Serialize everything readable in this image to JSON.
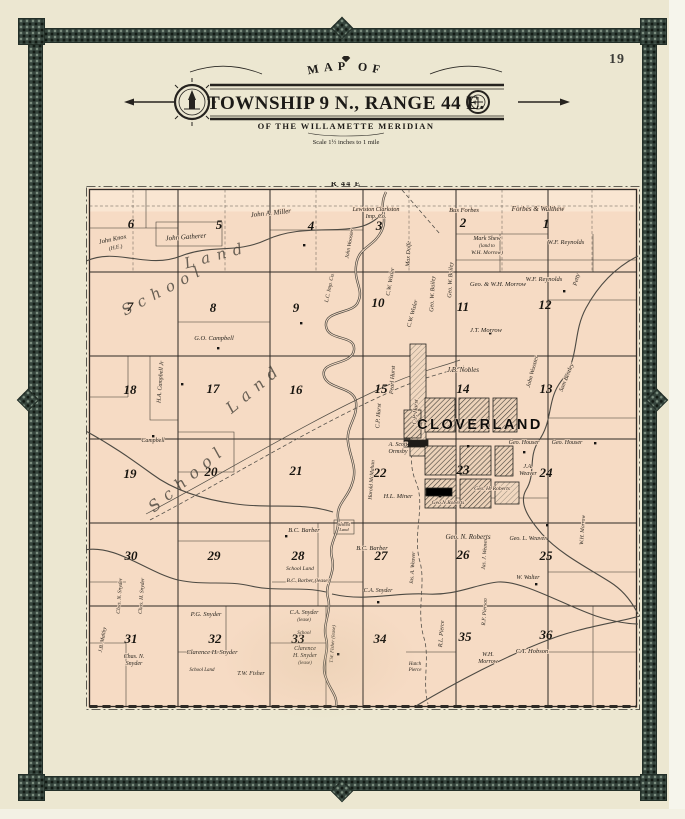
{
  "page": {
    "number": "19"
  },
  "colors": {
    "paper": "#ece7d1",
    "land": "#f6dbc4",
    "border_band": "#35443c",
    "ink": "#2e2a25"
  },
  "header": {
    "arc_title": "MAP OF",
    "main_title": "TOWNSHIP 9 N., RANGE 44 E.",
    "subtitle": "OF THE WILLAMETTE MERIDIAN",
    "scale_note": "Scale 1½ inches to 1 mile"
  },
  "map": {
    "range_label": "R 44 E",
    "town_label": "CLOVERLAND",
    "sections": [
      {
        "n": "6",
        "x": 45,
        "y": 46
      },
      {
        "n": "5",
        "x": 133,
        "y": 47
      },
      {
        "n": "4",
        "x": 225,
        "y": 48
      },
      {
        "n": "3",
        "x": 293,
        "y": 48
      },
      {
        "n": "2",
        "x": 377,
        "y": 45
      },
      {
        "n": "1",
        "x": 460,
        "y": 46
      },
      {
        "n": "7",
        "x": 44,
        "y": 129
      },
      {
        "n": "8",
        "x": 127,
        "y": 130
      },
      {
        "n": "9",
        "x": 210,
        "y": 130
      },
      {
        "n": "10",
        "x": 292,
        "y": 125
      },
      {
        "n": "11",
        "x": 377,
        "y": 129
      },
      {
        "n": "12",
        "x": 459,
        "y": 127
      },
      {
        "n": "18",
        "x": 44,
        "y": 212
      },
      {
        "n": "17",
        "x": 127,
        "y": 211
      },
      {
        "n": "16",
        "x": 210,
        "y": 212
      },
      {
        "n": "15",
        "x": 295,
        "y": 211
      },
      {
        "n": "14",
        "x": 377,
        "y": 211
      },
      {
        "n": "13",
        "x": 460,
        "y": 211
      },
      {
        "n": "19",
        "x": 44,
        "y": 296
      },
      {
        "n": "20",
        "x": 125,
        "y": 294
      },
      {
        "n": "21",
        "x": 210,
        "y": 293
      },
      {
        "n": "22",
        "x": 294,
        "y": 295
      },
      {
        "n": "23",
        "x": 377,
        "y": 292
      },
      {
        "n": "24",
        "x": 460,
        "y": 295
      },
      {
        "n": "30",
        "x": 45,
        "y": 378
      },
      {
        "n": "29",
        "x": 128,
        "y": 378
      },
      {
        "n": "28",
        "x": 212,
        "y": 378
      },
      {
        "n": "27",
        "x": 295,
        "y": 378
      },
      {
        "n": "26",
        "x": 377,
        "y": 377
      },
      {
        "n": "25",
        "x": 460,
        "y": 378
      },
      {
        "n": "31",
        "x": 45,
        "y": 461
      },
      {
        "n": "32",
        "x": 129,
        "y": 461
      },
      {
        "n": "33",
        "x": 212,
        "y": 461
      },
      {
        "n": "34",
        "x": 294,
        "y": 461
      },
      {
        "n": "35",
        "x": 379,
        "y": 459
      },
      {
        "n": "36",
        "x": 460,
        "y": 457
      }
    ],
    "labels": [
      {
        "t": "John Knox",
        "x": 27,
        "y": 59,
        "r": -12,
        "s": 6.5
      },
      {
        "t": "(H.E.)",
        "x": 30,
        "y": 67,
        "r": -12,
        "s": 5.5
      },
      {
        "t": "John Gatherer",
        "x": 100,
        "y": 57,
        "r": -4,
        "s": 7
      },
      {
        "t": "John A. Miller",
        "x": 185,
        "y": 33,
        "r": -6,
        "s": 7
      },
      {
        "t": "Lewiston Clarkston",
        "x": 290,
        "y": 29,
        "r": 0,
        "s": 6
      },
      {
        "t": "Imp. Co.",
        "x": 290,
        "y": 36,
        "r": 0,
        "s": 6
      },
      {
        "t": "Bus Forbes",
        "x": 378,
        "y": 30,
        "r": 0,
        "s": 6.5
      },
      {
        "t": "Forbes & Walthew",
        "x": 452,
        "y": 29,
        "r": 0,
        "s": 7
      },
      {
        "t": "Mark Shew",
        "x": 401,
        "y": 58,
        "r": 0,
        "s": 6
      },
      {
        "t": "(land to",
        "x": 401,
        "y": 65,
        "r": 0,
        "s": 5
      },
      {
        "t": "W.H. Morrow)",
        "x": 401,
        "y": 72,
        "r": 0,
        "s": 5.5
      },
      {
        "t": "W.F. Reynolds",
        "x": 480,
        "y": 62,
        "r": 0,
        "s": 6.5
      },
      {
        "t": "Geo. & W.H. Morrow",
        "x": 412,
        "y": 104,
        "r": 0,
        "s": 6.5
      },
      {
        "t": "W.F. Reynolds",
        "x": 458,
        "y": 99,
        "r": 0,
        "s": 6.5
      },
      {
        "t": "Geo. W. Bailey",
        "x": 348,
        "y": 112,
        "r": -87,
        "s": 6
      },
      {
        "t": "Geo. W. Bailey",
        "x": 366,
        "y": 98,
        "r": -87,
        "s": 6
      },
      {
        "t": "Max Dolfe",
        "x": 324,
        "y": 72,
        "r": -87,
        "s": 6
      },
      {
        "t": "C.W. Wisler",
        "x": 306,
        "y": 100,
        "r": -80,
        "s": 6
      },
      {
        "t": "C.W. Wisler",
        "x": 328,
        "y": 132,
        "r": -75,
        "s": 6
      },
      {
        "t": "John Wooster",
        "x": 265,
        "y": 62,
        "r": -80,
        "s": 5.5
      },
      {
        "t": "L.C. Imp. Co.",
        "x": 245,
        "y": 106,
        "r": -78,
        "s": 5.5
      },
      {
        "t": "Petty",
        "x": 492,
        "y": 98,
        "r": -75,
        "s": 6
      },
      {
        "t": "J.T. Morrow",
        "x": 400,
        "y": 150,
        "r": 0,
        "s": 6.5
      },
      {
        "t": "J.B. Nobles",
        "x": 377,
        "y": 190,
        "r": 0,
        "s": 7
      },
      {
        "t": "John Wooster",
        "x": 448,
        "y": 190,
        "r": -75,
        "s": 6
      },
      {
        "t": "Sam Bentley",
        "x": 482,
        "y": 196,
        "r": -68,
        "s": 6
      },
      {
        "t": "G.O. Campbell",
        "x": 128,
        "y": 158,
        "r": 0,
        "s": 6.5
      },
      {
        "t": "H.A. Campbell Jr",
        "x": 76,
        "y": 200,
        "r": -86,
        "s": 6
      },
      {
        "t": "Campbell",
        "x": 67,
        "y": 260,
        "r": 0,
        "s": 6
      },
      {
        "t": "Pearl Hurst",
        "x": 308,
        "y": 198,
        "r": -86,
        "s": 6
      },
      {
        "t": "C.P. Hurst",
        "x": 294,
        "y": 234,
        "r": -86,
        "s": 6
      },
      {
        "t": "C.P. Hurst",
        "x": 331,
        "y": 230,
        "r": -86,
        "s": 6
      },
      {
        "t": "A. Scott",
        "x": 312,
        "y": 264,
        "r": 0,
        "s": 6
      },
      {
        "t": "Ormsby",
        "x": 312,
        "y": 271,
        "r": 0,
        "s": 6
      },
      {
        "t": "H.L. Miner",
        "x": 312,
        "y": 316,
        "r": 0,
        "s": 6.5
      },
      {
        "t": "Harold McMahan",
        "x": 287,
        "y": 298,
        "r": -86,
        "s": 5.5
      },
      {
        "t": "Geo. Houser",
        "x": 438,
        "y": 262,
        "r": 0,
        "s": 6
      },
      {
        "t": "Geo. Houser",
        "x": 481,
        "y": 262,
        "r": 0,
        "s": 6
      },
      {
        "t": "J.A.",
        "x": 442,
        "y": 286,
        "r": 0,
        "s": 6
      },
      {
        "t": "Weaver",
        "x": 442,
        "y": 293,
        "r": 0,
        "s": 6
      },
      {
        "t": "Geo.N.Roberts",
        "x": 362,
        "y": 322,
        "r": 0,
        "s": 5.5
      },
      {
        "t": "Geo. H. Roberts",
        "x": 406,
        "y": 308,
        "r": 0,
        "s": 5.5
      },
      {
        "t": "Geo. N. Roberts",
        "x": 382,
        "y": 357,
        "r": 0,
        "s": 7
      },
      {
        "t": "Geo. L. Weaver",
        "x": 442,
        "y": 358,
        "r": 0,
        "s": 6
      },
      {
        "t": "Jas. J. Weaver",
        "x": 400,
        "y": 372,
        "r": -86,
        "s": 5.5
      },
      {
        "t": "Jas. A. Weaver",
        "x": 328,
        "y": 386,
        "r": -86,
        "s": 5.5
      },
      {
        "t": "W. Walter",
        "x": 442,
        "y": 397,
        "r": 0,
        "s": 6
      },
      {
        "t": "W.H. Morrow",
        "x": 498,
        "y": 348,
        "r": -86,
        "s": 5.5
      },
      {
        "t": "B.C. Barber",
        "x": 218,
        "y": 350,
        "r": 0,
        "s": 6.5
      },
      {
        "t": "B.C. Barber",
        "x": 286,
        "y": 368,
        "r": 0,
        "s": 6.5
      },
      {
        "t": "School  Land",
        "x": 214,
        "y": 388,
        "r": 0,
        "s": 5.5
      },
      {
        "t": "B.C. Barber (lease)",
        "x": 222,
        "y": 400,
        "r": 0,
        "s": 5.5
      },
      {
        "t": "C.A. Snyder",
        "x": 292,
        "y": 410,
        "r": 0,
        "s": 6
      },
      {
        "t": "P.G. Snyder",
        "x": 120,
        "y": 434,
        "r": 0,
        "s": 6.5
      },
      {
        "t": "C.A. Snyder",
        "x": 218,
        "y": 432,
        "r": 0,
        "s": 6
      },
      {
        "t": "(lease)",
        "x": 218,
        "y": 439,
        "r": 0,
        "s": 5
      },
      {
        "t": "School",
        "x": 218,
        "y": 452,
        "r": 0,
        "s": 5
      },
      {
        "t": "Chas. N. Snyder",
        "x": 35,
        "y": 414,
        "r": -86,
        "s": 5.5
      },
      {
        "t": "Chas. H. Snyder",
        "x": 57,
        "y": 414,
        "r": -86,
        "s": 5.5
      },
      {
        "t": "J.B. Maltby",
        "x": 18,
        "y": 458,
        "r": -80,
        "s": 5.5
      },
      {
        "t": "Chas. N.",
        "x": 48,
        "y": 476,
        "r": 0,
        "s": 6
      },
      {
        "t": "Snyder",
        "x": 48,
        "y": 483,
        "r": 0,
        "s": 6
      },
      {
        "t": "Clarence H. Snyder",
        "x": 126,
        "y": 472,
        "r": 0,
        "s": 6.5
      },
      {
        "t": "School  Land",
        "x": 116,
        "y": 489,
        "r": 0,
        "s": 5
      },
      {
        "t": "T.W. Fisher",
        "x": 165,
        "y": 493,
        "r": 0,
        "s": 6
      },
      {
        "t": "Clarence",
        "x": 219,
        "y": 468,
        "r": 0,
        "s": 6
      },
      {
        "t": "H. Snyder",
        "x": 219,
        "y": 475,
        "r": 0,
        "s": 6
      },
      {
        "t": "(lease)",
        "x": 219,
        "y": 482,
        "r": 0,
        "s": 5
      },
      {
        "t": "T.W. Fisher (lease)",
        "x": 248,
        "y": 462,
        "r": -86,
        "s": 5
      },
      {
        "t": "W.H.",
        "x": 402,
        "y": 474,
        "r": 0,
        "s": 6
      },
      {
        "t": "Morrow",
        "x": 402,
        "y": 481,
        "r": 0,
        "s": 6
      },
      {
        "t": "C.T. Hobson",
        "x": 446,
        "y": 471,
        "r": 0,
        "s": 6.5
      },
      {
        "t": "R.L. Pierce",
        "x": 357,
        "y": 452,
        "r": -86,
        "s": 6
      },
      {
        "t": "Hatch",
        "x": 329,
        "y": 483,
        "r": 0,
        "s": 5
      },
      {
        "t": "Pierce",
        "x": 329,
        "y": 489,
        "r": 0,
        "s": 5
      },
      {
        "t": "R.F. Pierson",
        "x": 400,
        "y": 430,
        "r": -86,
        "s": 5.5
      },
      {
        "t": "School",
        "x": 258,
        "y": 344,
        "r": 0,
        "s": 4.5
      },
      {
        "t": "Land",
        "x": 258,
        "y": 349,
        "r": 0,
        "s": 4.5
      }
    ],
    "script_labels": [
      {
        "t": "School",
        "x": 80,
        "y": 112,
        "r": -28,
        "s": 15
      },
      {
        "t": "Land",
        "x": 132,
        "y": 78,
        "r": -15,
        "s": 15
      },
      {
        "t": "School",
        "x": 105,
        "y": 300,
        "r": -40,
        "s": 16
      },
      {
        "t": "Land",
        "x": 172,
        "y": 210,
        "r": -40,
        "s": 16
      }
    ]
  }
}
